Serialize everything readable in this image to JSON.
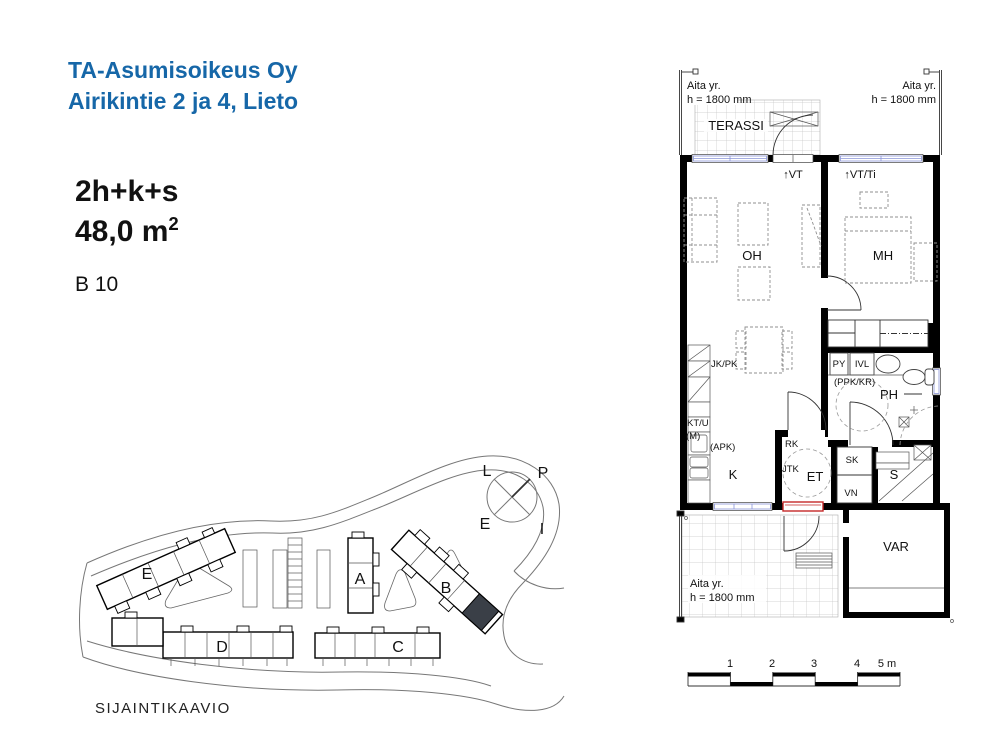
{
  "header": {
    "line1": "TA-Asumisoikeus Oy",
    "line2": "Airikintie 2 ja 4, Lieto"
  },
  "apartment": {
    "layout": "2h+k+s",
    "area": "48,0 m",
    "area_exponent": "2",
    "unit": "B 10"
  },
  "floorplan": {
    "fence": {
      "line1": "Aita yr.",
      "line2": "h = 1800 mm"
    },
    "terrace": "TERASSI",
    "vt": "↑VT",
    "vt_ti": "↑VT/Ti",
    "living": "OH",
    "bedroom": "MH",
    "kitchen": "K",
    "entry": "ET",
    "bathroom": "PH",
    "sauna": "S",
    "storage": "VAR",
    "fridge": "JK/PK",
    "stove": "KT/U",
    "microwave": "(M)",
    "dishwasher": "(APK)",
    "laundry": "PY",
    "ventilation": "IVL",
    "washer_dryer": "(PPK/KR)",
    "rk": "RK",
    "jtk": "JTK",
    "cleaning_closet": "SK",
    "vn": "VN"
  },
  "scale_bar": {
    "t1": "1",
    "t2": "2",
    "t3": "3",
    "t4": "4",
    "t5": "5 m"
  },
  "site_plan": {
    "title": "SIJAINTIKAAVIO",
    "buildings": {
      "a": "A",
      "b": "B",
      "c": "C",
      "d": "D",
      "e": "E"
    },
    "compass": {
      "l": "L",
      "p": "P",
      "e": "E",
      "i": "I"
    }
  },
  "colors": {
    "brand_blue": "#1667a8",
    "wall_black": "#000000",
    "window_blue": "#8a94d8",
    "entry_door_red": "#c42727",
    "highlighted_unit": "#3a3f47"
  }
}
